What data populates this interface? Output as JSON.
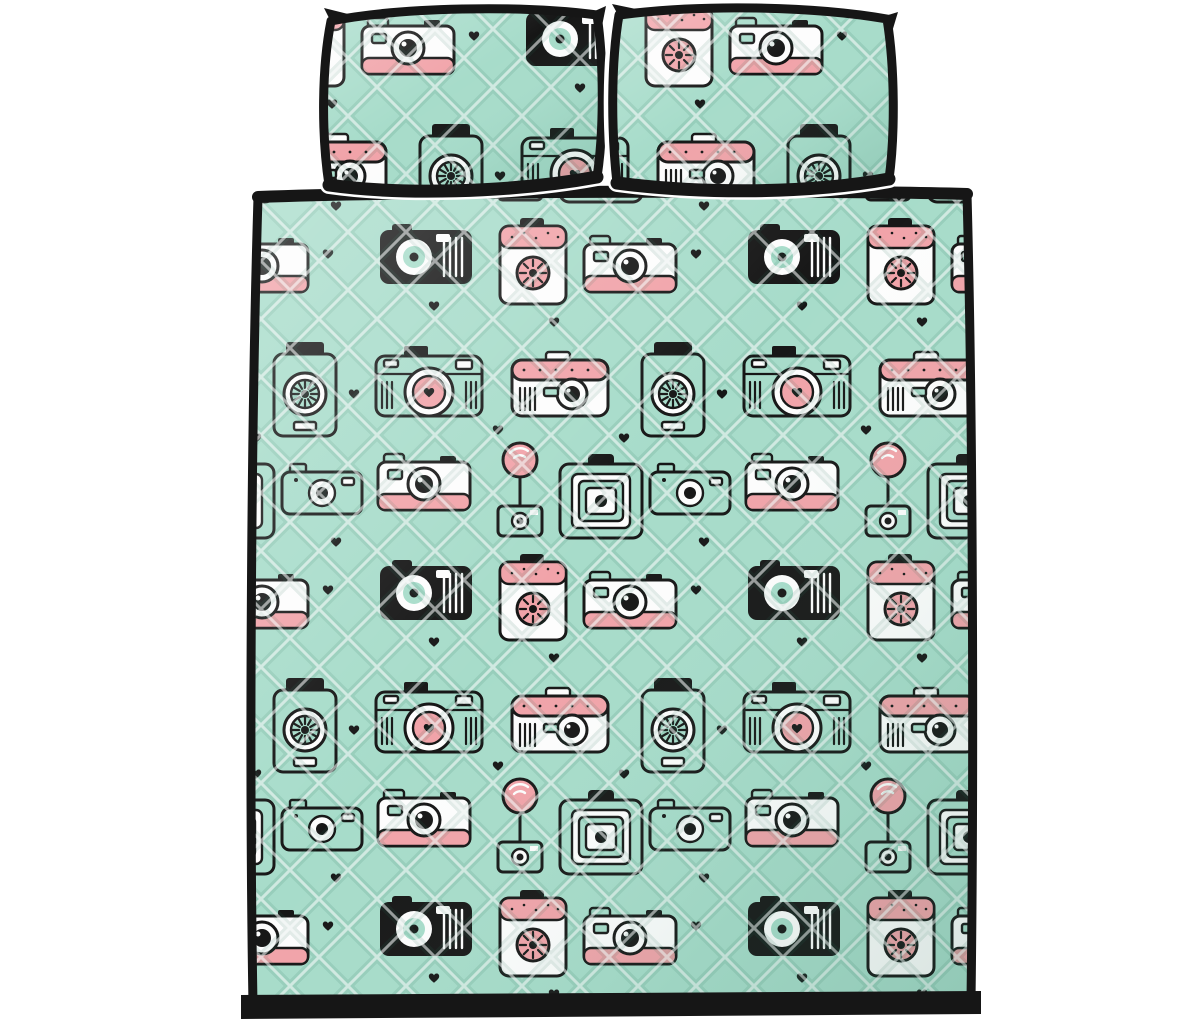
{
  "scene": {
    "title": "Cameras pattern quilt bed set — product photo on white background",
    "items": [
      {
        "label": "left pillow sham"
      },
      {
        "label": "right pillow sham"
      },
      {
        "label": "quilt with black binding"
      }
    ]
  },
  "colors": {
    "bg": "#ffffff",
    "mint": "#a7dcca",
    "mintL": "#c9ecdd",
    "pink": "#f1a3a9",
    "pinkL": "#f6bfc3",
    "ink": "#161616",
    "white": "#fdfdfd"
  },
  "pattern": {
    "name": "retro doodle cameras on quilted mint fabric",
    "motifs": [
      "slr-camera",
      "instant-camera",
      "box-camera",
      "flash-bulb",
      "folding-camera",
      "compact-camera",
      "rangefinder-camera",
      "mini-camera",
      "tall-camera",
      "heart"
    ]
  }
}
